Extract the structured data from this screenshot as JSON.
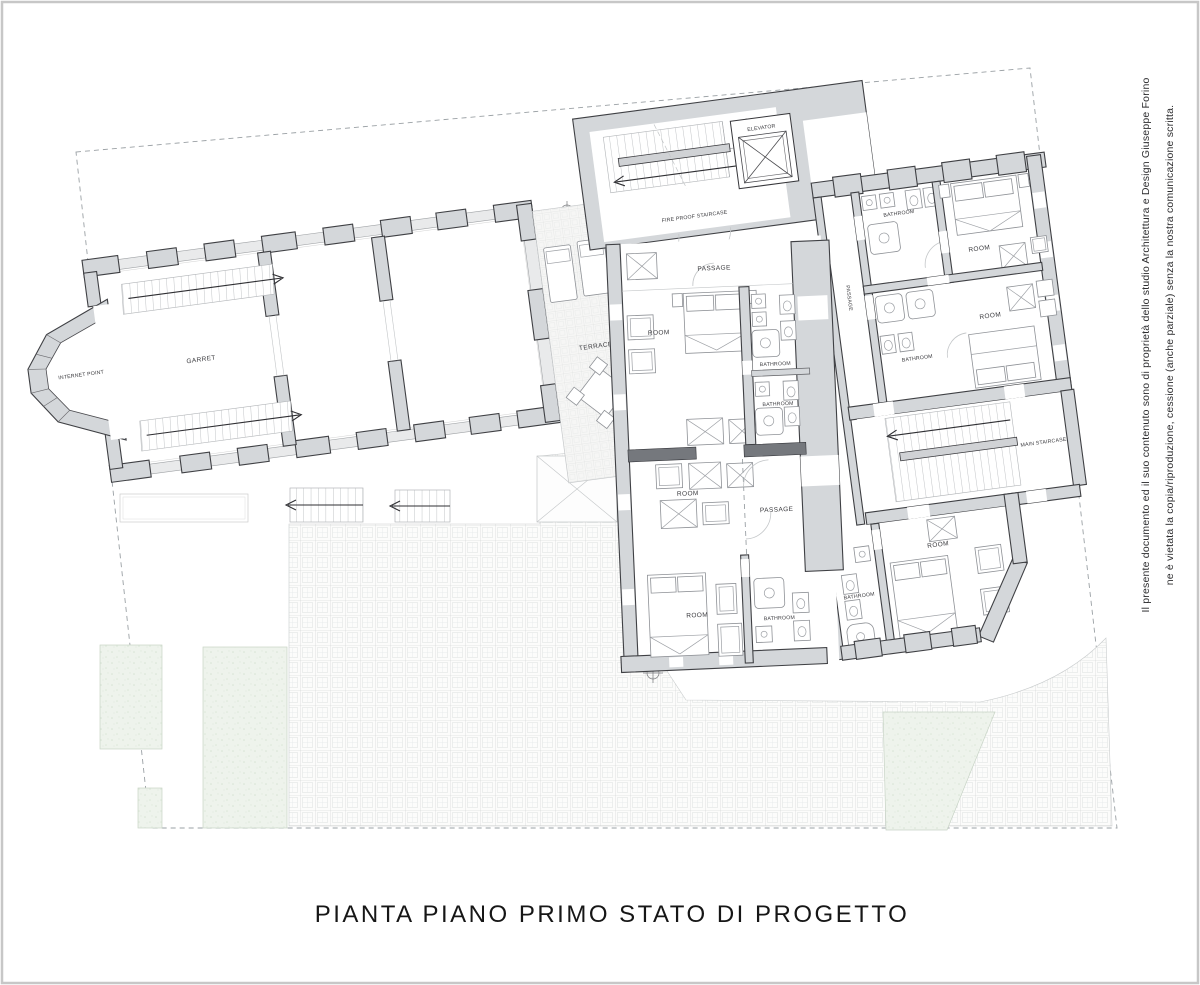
{
  "title": "PIANTA PIANO PRIMO STATO DI PROGETTO",
  "copyright": {
    "line1": "Il presente documento ed il suo contenuto sono di proprietà dello studio Architettura e Design Giuseppe Forino",
    "line2": "ne è vietata la copia/riproduzione, cessione (anche parziale) senza la nostra comunicazione scritta."
  },
  "labels": {
    "internet_point": "INTERNET POINT",
    "garret": "GARRET",
    "terrace": "TERRACE",
    "fire_staircase": "FIRE PROOF STAIRCASE",
    "elevator": "ELEVATOR",
    "passage_center_top": "PASSAGE",
    "room_center_top": "ROOM",
    "bathroom_center_1": "BATHROOM",
    "bathroom_center_2": "BATHROOM",
    "room_center_mid": "ROOM",
    "passage_center_mid": "PASSAGE",
    "room_center_bottom": "ROOM",
    "bathroom_center_3": "BATHROOM",
    "bathroom_right_top": "BATHROOM",
    "room_right_top": "ROOM",
    "passage_right": "PASSAGE",
    "bathroom_right_mid": "BATHROOM",
    "room_right_mid": "ROOM",
    "main_staircase": "MAIN STAIRCASE",
    "room_bottom_right": "ROOM",
    "bathroom_bottom_right": "BATHROOM"
  },
  "colors": {
    "wall_fill": "#d4d7da",
    "wall_line": "#3f4044",
    "grass": "#eef3ec",
    "paving_line": "#ccd0d0",
    "boundary": "#9aa0a4",
    "text": "#2c2c2e"
  }
}
